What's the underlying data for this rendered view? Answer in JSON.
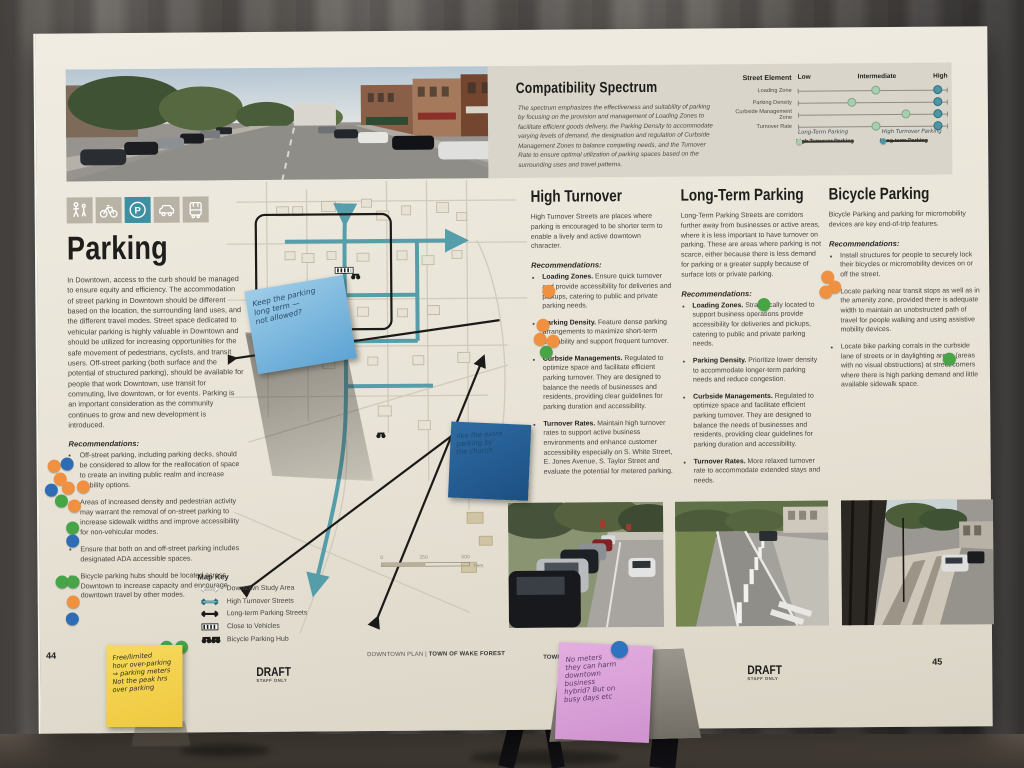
{
  "poster": {
    "page_left": "44",
    "page_right": "45",
    "footer_left_plain": "DOWNTOWN PLAN | ",
    "footer_left_bold": "TOWN OF WAKE FOREST",
    "footer_right_bold": "TOWN OF WAKE FOREST",
    "footer_right_plain": " | DOWNTOWN PLAN",
    "draft": "DRAFT",
    "draft_sub": "STAFF ONLY"
  },
  "colors": {
    "accent_teal": "#3e8fa1",
    "dot_orange": "#ef9140",
    "dot_blue": "#2e6cb5",
    "dot_green": "#47a447",
    "spectrum_light_green": "#a9cdaf",
    "spectrum_teal": "#4d96a5"
  },
  "modes": {
    "items": [
      "pedestrian",
      "bicycle",
      "parking",
      "car",
      "bus"
    ],
    "active": "parking"
  },
  "spectrum": {
    "title": "Compatibility Spectrum",
    "description": "The spectrum emphasizes the effectiveness and suitability of parking by focusing on the provision and management of Loading Zones to facilitate efficient goods delivery, the Parking Density to accommodate varying levels of demand, the designation and regulation of Curbside Management Zones to balance competing needs, and the Turnover Rate to ensure optimal utilization of parking spaces based on the surrounding uses and travel patterns.",
    "col_header": "Street Element",
    "low": "Low",
    "intermediate": "Intermediate",
    "high": "High",
    "rows": [
      {
        "label": "Loading Zone",
        "green_style": "left:52%",
        "teal_style": "left:93%"
      },
      {
        "label": "Parking Density",
        "green_style": "left:36%",
        "teal_style": "left:93%"
      },
      {
        "label": "Curbside Management Zone",
        "green_style": "left:72%",
        "teal_style": "left:93%"
      },
      {
        "label": "Turnover Rate",
        "green_style": "left:52%",
        "teal_style": "left:93%"
      }
    ],
    "legend": [
      {
        "written": "Long-Term Parking",
        "crossed": "High Turnover Parking"
      },
      {
        "written": "High Turnover Parking",
        "crossed": "Long-term Parking"
      }
    ]
  },
  "parking": {
    "title": "Parking",
    "body": "In Downtown, access to the curb should be managed to ensure equity and efficiency. The accommodation of street parking in Downtown should be different based on the location, the surrounding land uses, and the different travel modes. Street space dedicated to vehicular parking is highly valuable in Downtown and should be utilized for increasing opportunities for the safe movement of pedestrians, cyclists, and transit users. Off-street parking (both surface and the potential of structured parking), should be available for people that work Downtown, use transit for commuting, live downtown, or for events. Parking is an important consideration as the community continues to grow and new development is introduced.",
    "rec_heading": "Recommendations:",
    "bullets": [
      "Off-street parking, including parking decks, should be considered to allow for the reallocation of space to create an inviting public realm and increase mobility options.",
      "Areas of increased density and pedestrian activity may warrant the removal of on-street parking to increase sidewalk widths and improve accessibility for non-vehicular modes.",
      "Ensure that both on and off-street parking includes designated ADA accessible spaces.",
      "Bicycle parking hubs should be located across Downtown to increase capacity and encourage downtown travel by other modes."
    ]
  },
  "map": {
    "key_title": "Map Key",
    "key_items": [
      "Downtown Study Area",
      "High Turnover Streets",
      "Long-term Parking Streets",
      "Close to Vehicles",
      "Bicycle Parking Hub"
    ],
    "scale_0": "0",
    "scale_250": "250",
    "scale_500": "500",
    "scale_unit": "Feet"
  },
  "high_turnover": {
    "title": "High Turnover",
    "intro": "High Turnover Streets are places where parking is encouraged to be shorter term to enable a lively and active downtown character.",
    "rec_heading": "Recommendations:",
    "bullets": [
      {
        "lead": "Loading Zones.",
        "text": " Ensure quick turnover and provide accessibility for deliveries and pickups, catering to public and private parking needs."
      },
      {
        "lead": "Parking Density.",
        "text": " Feature dense parking arrangements to maximize short-term availability and support frequent turnover."
      },
      {
        "lead": "Curbside Managements.",
        "text": " Regulated to optimize space and facilitate efficient parking turnover. They are designed to balance the needs of businesses and residents, providing clear guidelines for parking duration and accessibility."
      },
      {
        "lead": "Turnover Rates.",
        "text": " Maintain high turnover rates to support active business environments and enhance customer accessibility especially on S. White Street, E. Jones Avenue, S. Taylor Street and evaluate the potential for metered parking."
      }
    ]
  },
  "long_term": {
    "title": "Long-Term Parking",
    "intro": "Long-Term Parking Streets are corridors further away from businesses or active areas, where it is less important to have turnover on parking. These are areas where parking is not scarce, either because there is less demand for parking or a greater supply because of surface lots or private parking.",
    "rec_heading": "Recommendations:",
    "bullets": [
      {
        "lead": "Loading Zones.",
        "text": " Strategically located to support business operations provide accessibility for deliveries and pickups, catering to public and private parking needs."
      },
      {
        "lead": "Parking Density.",
        "text": " Prioritize lower density to accommodate longer-term parking needs and reduce congestion."
      },
      {
        "lead": "Curbside Managements.",
        "text": " Regulated to optimize space and facilitate efficient parking turnover. They are designed to balance the needs of businesses and residents, providing clear guidelines for parking duration and accessibility."
      },
      {
        "lead": "Turnover Rates.",
        "text": " More relaxed turnover rate to accommodate extended stays and needs."
      }
    ]
  },
  "bicycle": {
    "title": "Bicycle Parking",
    "intro": "Bicycle Parking and parking for micromobility devices are key end-of-trip features.",
    "rec_heading": "Recommendations:",
    "bullets": [
      "Install structures for people to securely lock their bicycles or micromobility devices on or off the street.",
      "Locate parking near transit stops as well as in the amenity zone, provided there is adequate width to maintain an unobstructed path of travel for people walking and using assistive mobility devices.",
      "Locate bike parking corrals in the curbside lane of streets or in daylighting areas (areas with no visual obstructions) at street corners where there is high parking demand and little available sidewalk space."
    ]
  },
  "stickies": {
    "blue1_lines": [
      "Keep the parking",
      "long term —",
      "not allowed?"
    ],
    "blue2_lines": [
      "like the extra",
      "parking by",
      "the church"
    ],
    "yellow_lines": [
      "Free/limited",
      "hour over-parking",
      "⇒ parking meters",
      "Not the peak hrs",
      "over parking"
    ],
    "pink_lines": [
      "No meters",
      "they can harm",
      "downtown",
      "business",
      "hybrid? But on",
      "busy days etc"
    ]
  }
}
